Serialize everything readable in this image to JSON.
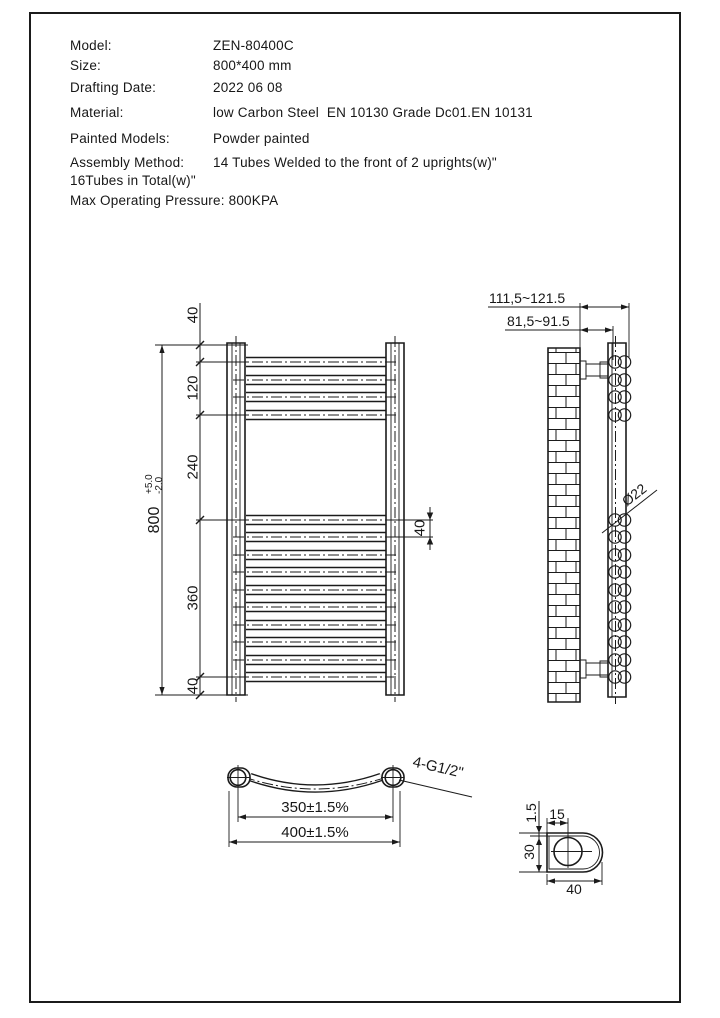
{
  "page": {
    "background": "#ffffff",
    "line_color": "#1b1b1b"
  },
  "specs": {
    "rows": [
      {
        "label": "Model:",
        "value": "ZEN-80400C"
      },
      {
        "label": "Size:",
        "value": "800*400 mm"
      },
      {
        "label": "Drafting Date:",
        "value": "2022 06 08"
      },
      {
        "label": "Material:",
        "value": "low Carbon Steel  EN 10130 Grade Dc01.EN 10131"
      },
      {
        "label": "Painted Models:",
        "value": "Powder painted"
      },
      {
        "label": "Assembly Method:",
        "value": "14 Tubes Welded to the front of 2 uprights(w)\""
      },
      {
        "label": "16Tubes in Total(w)\"",
        "value": ""
      },
      {
        "label": "Max Operating Pressure: ",
        "value": "800KPA"
      }
    ]
  },
  "front_view": {
    "dim_top_gap": "40",
    "dim_top_group": "120",
    "dim_middle_gap": "240",
    "dim_bottom_group": "360",
    "dim_bottom_gap": "40",
    "dim_overall": "800",
    "dim_overall_tol_plus": "+5.0",
    "dim_overall_tol_minus": "-2.0",
    "dim_tube_pitch": "40"
  },
  "side_view": {
    "dim_wall_to_tube_front": "111,5~121.5",
    "dim_wall_to_upright": "81,5~91.5",
    "tube_diameter": "Ø22"
  },
  "bottom_view": {
    "dim_centers": "350±1.5%",
    "dim_overall_width": "400±1.5%",
    "connection_label": "4-G1/2\""
  },
  "detail_view": {
    "dim_wall_thickness": "1.5",
    "dim_hole_offset": "15",
    "dim_profile_height": "30",
    "dim_profile_width": "40"
  }
}
